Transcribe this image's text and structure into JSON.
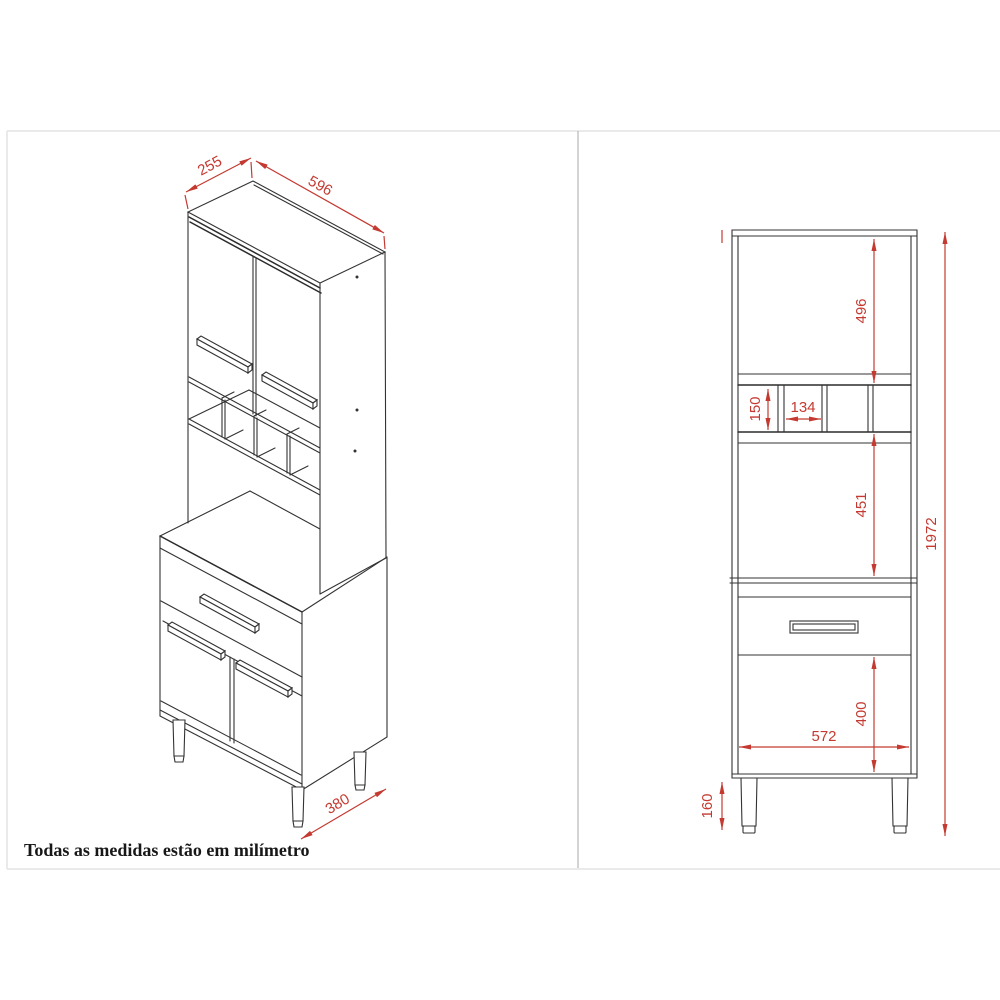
{
  "note": "Todas as medidas estão em milímetro",
  "dimensions": {
    "isometric": {
      "top_depth": "255",
      "top_width": "596",
      "base_depth": "380"
    },
    "elevation": {
      "upper_section_height": "496",
      "niche_height": "150",
      "niche_cell_width": "134",
      "middle_section_height": "451",
      "lower_section_height": "400",
      "inner_width": "572",
      "leg_height": "160",
      "total_height": "1972"
    }
  },
  "colors": {
    "dimension_red": "#c43a31",
    "drawing_line": "#333333",
    "frame_border": "#e4e4e4"
  }
}
